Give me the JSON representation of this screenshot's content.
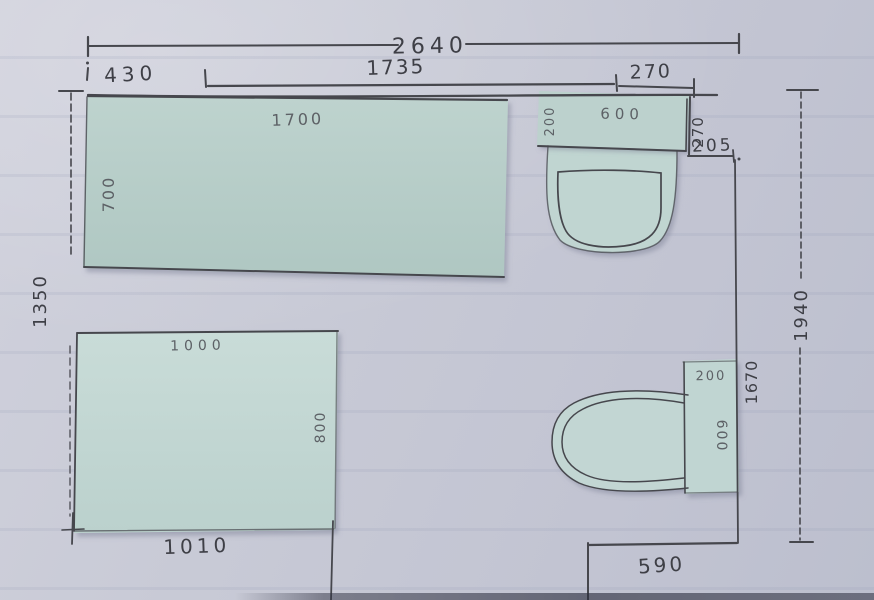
{
  "scene": {
    "description": "Photograph of a hand-drawn bathroom floor plan sketched in pen on pale lined paper, with light-green paper cut-outs representing the bath, shower tray, sink and toilet"
  },
  "labels": {
    "total_width": "2640",
    "seg_left": "430",
    "seg_mid": "1735",
    "seg_right": "270",
    "left_height": "1350",
    "right_height": "1940",
    "wall_recess_depth": "270",
    "wall_recess_width": "205",
    "right_lower_height": "1670",
    "bottom_left_width": "1010",
    "bottom_right_width": "590"
  },
  "shapes": {
    "bath": {
      "name": "bath cut-out",
      "width": "1700",
      "depth": "700"
    },
    "shower": {
      "name": "shower cut-out",
      "width": "1000",
      "depth": "800"
    },
    "sink": {
      "name": "sink cut-out",
      "width": "600",
      "depth": "200"
    },
    "toilet": {
      "name": "toilet cut-out",
      "width": "200",
      "depth": "600"
    }
  },
  "colors": {
    "paper": "#c7c9d5",
    "cutout": "#bdd2cd",
    "pen": "#46474d",
    "pencil": "#5d6166"
  }
}
